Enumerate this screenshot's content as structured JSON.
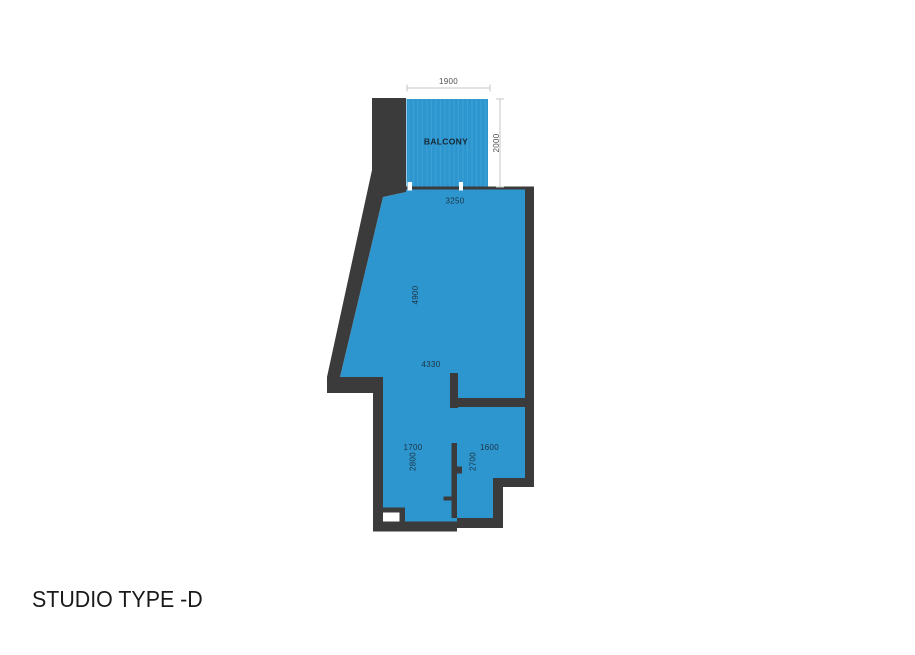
{
  "title": "STUDIO TYPE -D",
  "plan": {
    "balcony_label": "BALCONY",
    "dims": {
      "balcony_width": "1900",
      "balcony_depth": "2000",
      "entry_width": "3250",
      "living_length": "4900",
      "living_width": "4330",
      "bed_width": "1700",
      "bed_depth": "2800",
      "bath_width": "1600",
      "bath_depth": "2700"
    }
  },
  "colors": {
    "floor_fill": "#2D96CF",
    "wall": "#3B3B3B",
    "dim_line": "#C6C6C6",
    "dim_text": "#4F4F4F",
    "room_text": "#1D3340",
    "title_text": "#1A1A1A"
  }
}
